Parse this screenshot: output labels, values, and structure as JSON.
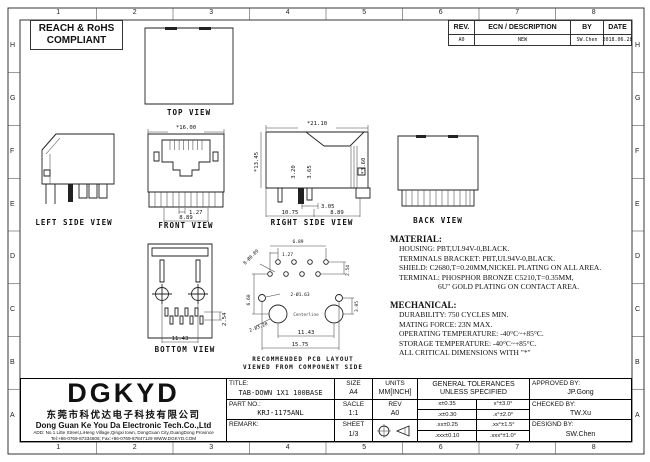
{
  "compliance": {
    "line1": "REACH & RoHS",
    "line2": "COMPLIANT"
  },
  "zones": {
    "columns": [
      "1",
      "2",
      "3",
      "4",
      "5",
      "6",
      "7",
      "8"
    ],
    "rows": [
      "H",
      "G",
      "F",
      "E",
      "D",
      "C",
      "B",
      "A"
    ]
  },
  "revision": {
    "headers": [
      "REV.",
      "ECN / DESCRIPTION",
      "BY",
      "DATE"
    ],
    "rows": [
      [
        "A0",
        "NEW",
        "SW.Chen",
        "2018.06.28"
      ]
    ]
  },
  "views": {
    "top": {
      "label": "TOP VIEW"
    },
    "left_side": {
      "label": "LEFT SIDE VIEW"
    },
    "front": {
      "label": "FRONT VIEW",
      "dim_width": "*16.00",
      "dim_pitch": "1.27",
      "dim_span": "8.89"
    },
    "right_side": {
      "label": "RIGHT SIDE VIEW",
      "dim_width": "*21.10",
      "dim_height": "*13.45",
      "dim_a": "3.20",
      "dim_b": "3.65",
      "dim_c": "*3.60",
      "dim_d": "3.05",
      "dim_e": "10.75",
      "dim_f": "8.89"
    },
    "back": {
      "label": "BACK VIEW"
    },
    "bottom": {
      "label": "BOTTOM VIEW",
      "dim_a": "11.43",
      "dim_b": "2.54"
    },
    "pcb": {
      "caption_line1": "RECOMMENDED PCB LAYOUT",
      "caption_line2": "VIEWED FROM COMPONENT SIDE",
      "centerline": "Centerline",
      "dim_holes": "8-Ø0.89",
      "dim_top": "6.89",
      "dim_pitch": "1.27",
      "dim_row": "2.54",
      "dim_mid_holes": "2-Ø1.63",
      "dim_posts": "2-Ø3.20",
      "dim_left": "6.60",
      "dim_right": "3.05",
      "dim_post_span": "11.43",
      "dim_total": "15.75"
    }
  },
  "material": {
    "title": "MATERIAL:",
    "lines": [
      "HOUSING: PBT,UL94V-0,BLACK.",
      "TERMINALS BRACKET: PBT,UL94V-0,BLACK.",
      "SHIELD: C2680,T=0.20MM,NICKEL PLATING ON ALL AREA.",
      "TERMINAL: PHOSPHOR BRONZE C5210,T=0.35MM,",
      "6U\" GOLD PLATING ON CONTACT AREA."
    ]
  },
  "mechanical": {
    "title": "MECHANICAL:",
    "lines": [
      "DURABILITY: 750 CYCLES MIN.",
      "MATING FORCE: 23N MAX.",
      "OPERATING TEMPERATURE: -40°C~+85°C.",
      "STORAGE TEMPERATURE: -40°C~+85°C.",
      "ALL CRITICAL DIMENSIONS WITH \"*\""
    ]
  },
  "title_block": {
    "title_label": "TITLE:",
    "title_value": "TAB-DOWN 1X1 100BASE",
    "size_label": "SIZE",
    "size_value": "A4",
    "units_label": "UNITS",
    "units_value": "MM[INCH]",
    "tol_header1": "GENERAL TOLERANCES",
    "tol_header2": "UNLESS SPECIFIED",
    "approved_label": "APPROVED BY:",
    "approved_value": "JP.Gong",
    "part_label": "PART NO.:",
    "part_value": "KRJ-1175ANL",
    "scale_label": "SACLE",
    "scale_value": "1:1",
    "rev_label": "REV",
    "rev_value": "A0",
    "checked_label": "CHECKED BY:",
    "checked_value": "TW.Xu",
    "remark_label": "REMARK:",
    "sheet_label": "SHEET",
    "sheet_value": "1/3",
    "designed_label": "DESIGND BY:",
    "designed_value": "SW.Chen",
    "tolerances": [
      [
        "x±0.35",
        "x°±3.0°"
      ],
      [
        ".x±0.30",
        ".x°±2.0°"
      ],
      [
        ".xx±0.25",
        ".xx°±1.5°"
      ],
      [
        ".xxx±0.10",
        ".xxx°±1.0°"
      ]
    ]
  },
  "company": {
    "logo": "DGKYD",
    "name_cn": "东莞市科优达电子科技有限公司",
    "name_en": "Dong Guan Ke You Da Electronic Tech.Co.,Ltd",
    "address": "ADD: No.1 Litte Street,LiHeng Village,Qingxi town, DongGuan City,GuangDong Province",
    "contact": "Tel:+86-0769-87334606; Fax:+86-0769-87847129  WWW.DGKYD.COM"
  }
}
